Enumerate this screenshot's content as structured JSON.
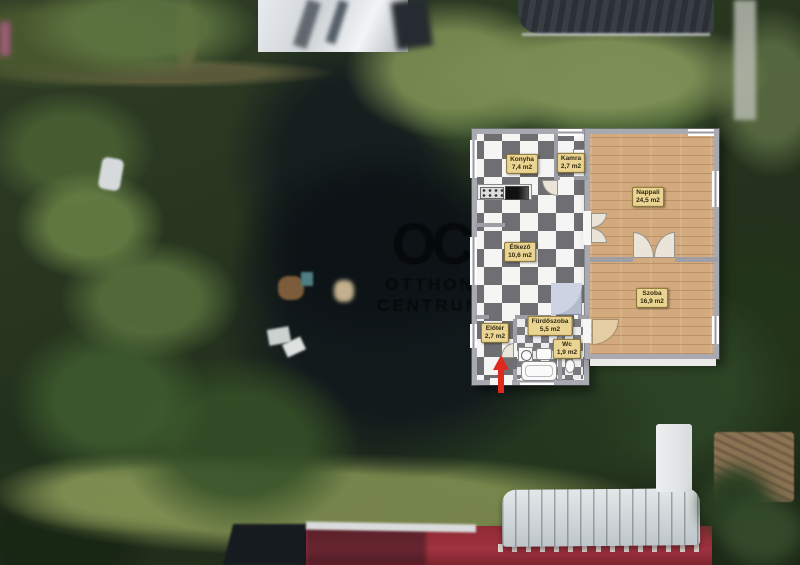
{
  "floor_plan": {
    "rooms": [
      {
        "id": "konyha",
        "name": "Konyha",
        "area": "7,4 m2"
      },
      {
        "id": "kamra",
        "name": "Kamra",
        "area": "2,7 m2"
      },
      {
        "id": "nappali",
        "name": "Nappali",
        "area": "24,5 m2"
      },
      {
        "id": "etkezo",
        "name": "Étkező",
        "area": "10,6 m2"
      },
      {
        "id": "szoba",
        "name": "Szoba",
        "area": "16,9 m2"
      },
      {
        "id": "eloter",
        "name": "Előtér",
        "area": "2,7 m2"
      },
      {
        "id": "furdoszoba",
        "name": "Fürdőszoba",
        "area": "5,5 m2"
      },
      {
        "id": "wc",
        "name": "Wc",
        "area": "1,9 m2"
      }
    ],
    "entrance_marker": "red arrow at bottom entrance pointing up",
    "colors": {
      "wall": "#a9a9b1",
      "checker_dark": "#6f6f73",
      "checker_light": "#f5f5f3",
      "wood_floor": "#d2aa7d",
      "label_bg": "#e9d494",
      "label_border": "#8a7433",
      "arrow_red": "#dd2a1c"
    }
  },
  "watermark": {
    "logo": "OC",
    "line1": "OTTHON",
    "line2": "CENTRUM"
  },
  "background": {
    "description": "aerial satellite photo of a tree-filled garden plot with lawns, sheds, a greenhouse and red rooftops"
  }
}
